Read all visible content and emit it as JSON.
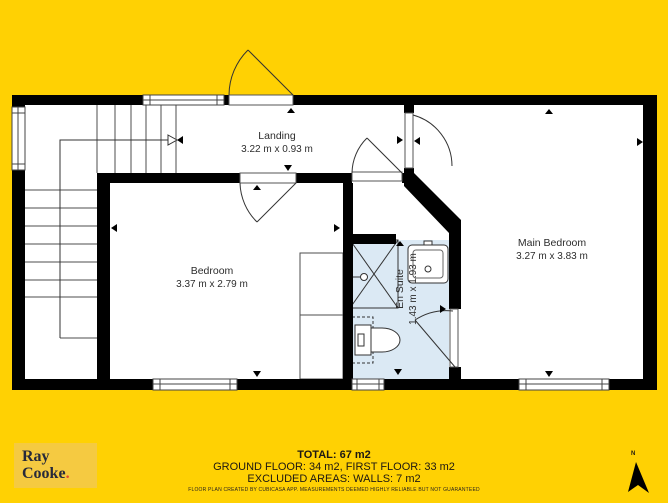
{
  "colors": {
    "background": "#ffd103",
    "walls": "#000000",
    "ensuite_floor": "#dbe9f4",
    "logo_box": "#f5ca41",
    "logo_text": "#272a3a",
    "logo_dot": "#e2492f"
  },
  "plan": {
    "rooms": [
      {
        "name": "Landing",
        "dims": "3.22 m x 0.93 m"
      },
      {
        "name": "Bedroom",
        "dims": "3.37 m x 2.79 m"
      },
      {
        "name": "Main Bedroom",
        "dims": "3.27 m x 3.83 m"
      },
      {
        "name": "En Suite",
        "dims": "1.43 m x 1.93 m"
      }
    ]
  },
  "footer": {
    "total": "TOTAL: 67 m2",
    "floors": "GROUND FLOOR: 34 m2, FIRST FLOOR: 33 m2",
    "excluded": "EXCLUDED AREAS: WALLS: 7 m2",
    "disclaimer": "FLOOR PLAN CREATED BY CUBICASA APP. MEASUREMENTS DEEMED HIGHLY RELIABLE BUT NOT GUARANTEED"
  },
  "logo": {
    "line1": "Ray",
    "line2": "Cooke",
    "dot": "."
  },
  "compass": {
    "label": "N"
  }
}
